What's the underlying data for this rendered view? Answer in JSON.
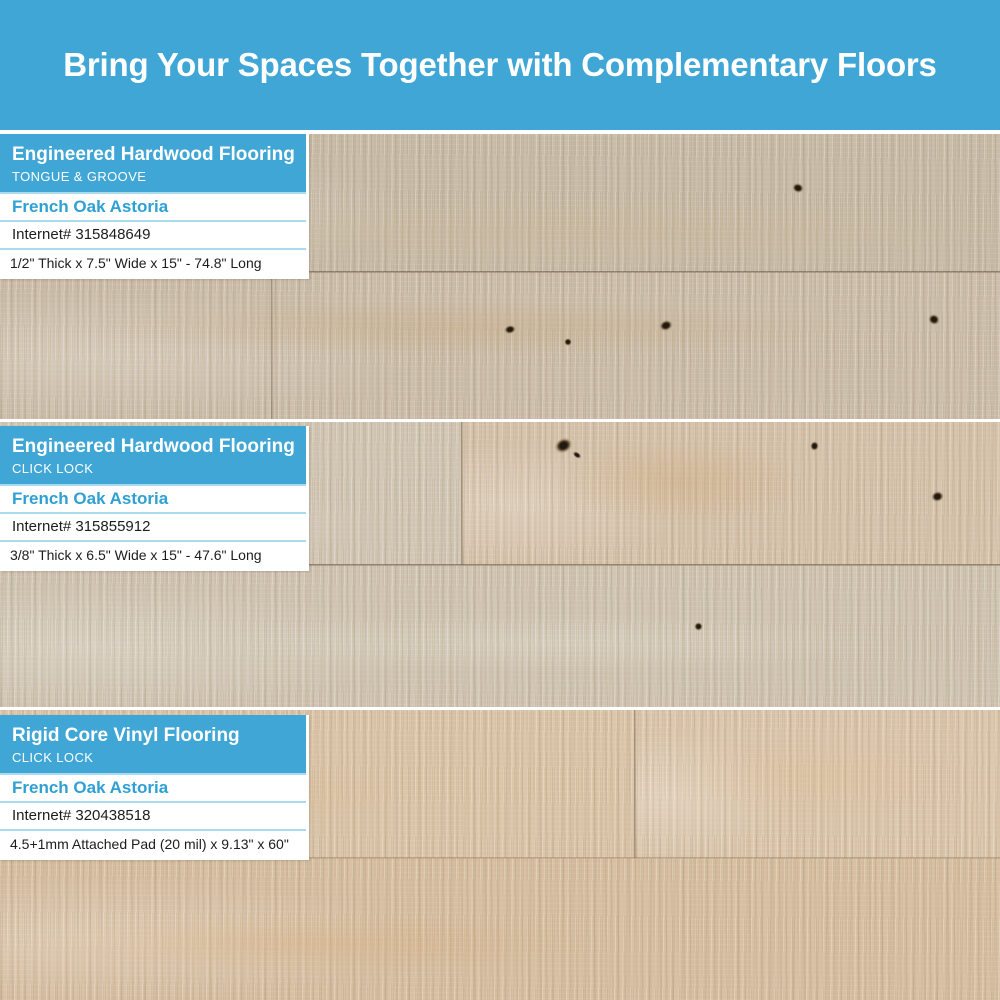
{
  "banner": {
    "title": "Bring Your Spaces Together with Complementary Floors"
  },
  "sections": [
    {
      "category": "Engineered Hardwood Flooring",
      "install_type": "TONGUE & GROOVE",
      "product_name": "French Oak Astoria",
      "internet_number": "Internet# 315848649",
      "dimensions": "1/2\" Thick x 7.5\" Wide x 15\" - 74.8\" Long"
    },
    {
      "category": "Engineered Hardwood Flooring",
      "install_type": "CLICK LOCK",
      "product_name": "French Oak Astoria",
      "internet_number": "Internet# 315855912",
      "dimensions": "3/8\" Thick x 6.5\" Wide x 15\" - 47.6\" Long"
    },
    {
      "category": "Rigid Core Vinyl Flooring",
      "install_type": "CLICK LOCK",
      "product_name": "French Oak Astoria",
      "internet_number": "Internet# 320438518",
      "dimensions": "4.5+1mm Attached Pad (20 mil) x 9.13\" x 60\""
    }
  ],
  "colors": {
    "accent_blue": "#3fa6d6",
    "product_name_blue": "#2fa0d3",
    "divider_blue": "#a9daf0",
    "banner_text": "#ffffff"
  }
}
